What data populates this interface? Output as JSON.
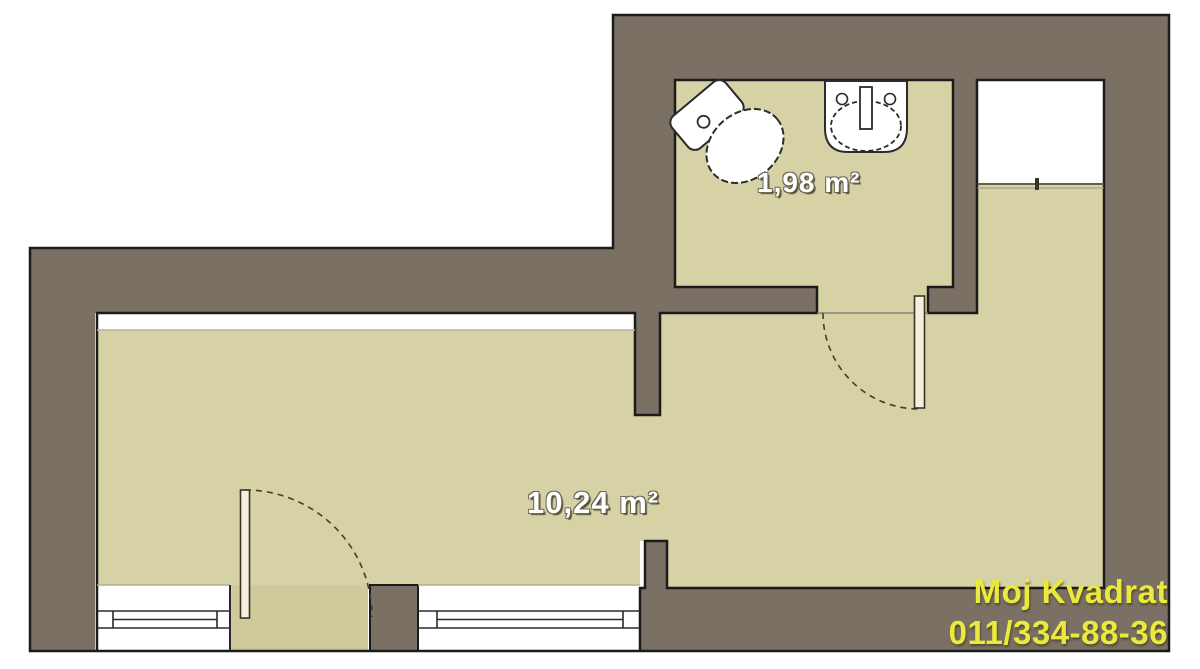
{
  "plan": {
    "type": "apartment-floor-plan",
    "rooms": [
      {
        "id": "bathroom",
        "area_label": "1,98 m²"
      },
      {
        "id": "main-room",
        "area_label": "10,24 m²"
      }
    ],
    "fixtures": [
      {
        "name": "toilet"
      },
      {
        "name": "sink"
      }
    ],
    "doors": [
      {
        "name": "entry-door"
      },
      {
        "name": "bathroom-door"
      }
    ],
    "windows": [
      {
        "name": "window-left"
      },
      {
        "name": "window-right"
      },
      {
        "name": "window-niche"
      }
    ],
    "colors": {
      "wall": "#7a7164",
      "floor": "#d7d1a6",
      "outline": "#1b1b1b",
      "background": "#ffffff",
      "label_text": "#ffffff",
      "watermark_yellow": "#ebe93e"
    }
  },
  "watermark": {
    "name": "Moj Kvadrat",
    "phone": "011/334-88-36"
  }
}
